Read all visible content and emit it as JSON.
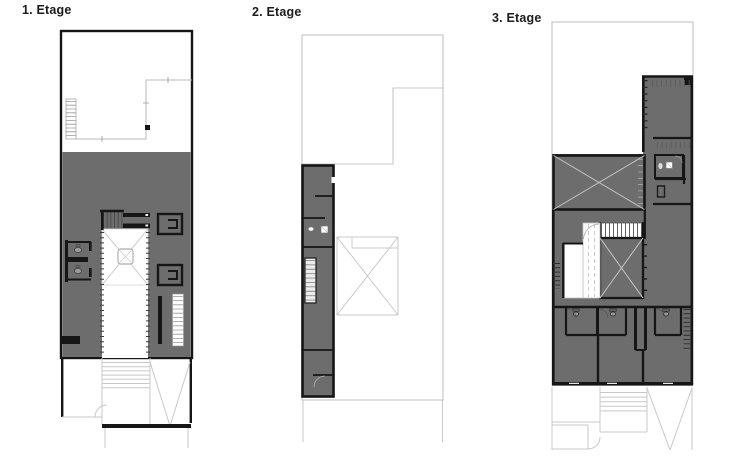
{
  "sheet": {
    "title": "Floor plan sheet"
  },
  "colors": {
    "bg": "#ffffff",
    "wall": "#161616",
    "floor": "#6d6d6d",
    "ghost": "#c8c8c8",
    "thin": "#b9b9b9",
    "diag": "#c6c6c6",
    "label": "#1c1c1c"
  },
  "plans": [
    {
      "label": "1. Etage"
    },
    {
      "label": "2. Etage"
    },
    {
      "label": "3. Etage"
    }
  ]
}
